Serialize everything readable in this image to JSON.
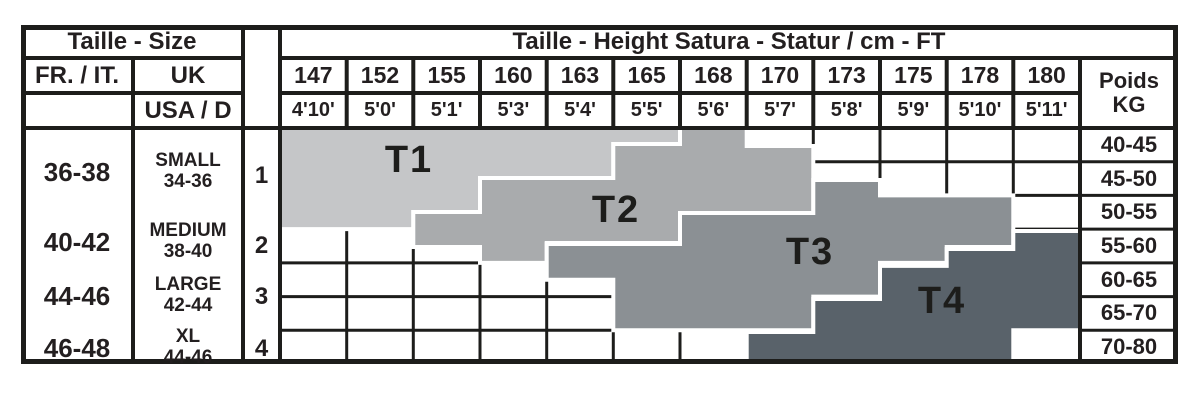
{
  "chart_data": {
    "type": "table",
    "title_left": "Taille - Size",
    "title_right": "Taille - Height Satura - Statur / cm - FT",
    "col_headers": {
      "fr_it": "FR. / IT.",
      "uk": "UK",
      "usa_d": "USA / D"
    },
    "weight_header": {
      "line1": "Poids",
      "line2": "KG"
    },
    "heights_cm": [
      "147",
      "152",
      "155",
      "160",
      "163",
      "165",
      "168",
      "170",
      "173",
      "175",
      "178",
      "180"
    ],
    "heights_ft": [
      "4'10'",
      "5'0'",
      "5'1'",
      "5'3'",
      "5'4'",
      "5'5'",
      "5'6'",
      "5'7'",
      "5'8'",
      "5'9'",
      "5'10'",
      "5'11'"
    ],
    "weights_kg": [
      "40-45",
      "45-50",
      "50-55",
      "55-60",
      "60-65",
      "65-70",
      "70-80"
    ],
    "size_rows": [
      {
        "fr_it": "36-38",
        "uk": "SMALL",
        "uk_range": "34-36",
        "usa_d": "1"
      },
      {
        "fr_it": "40-42",
        "uk": "MEDIUM",
        "uk_range": "38-40",
        "usa_d": "2"
      },
      {
        "fr_it": "44-46",
        "uk": "LARGE",
        "uk_range": "42-44",
        "usa_d": "3"
      },
      {
        "fr_it": "46-48",
        "uk": "XL",
        "uk_range": "44-46",
        "usa_d": "4"
      }
    ],
    "bands": [
      {
        "label": "T1",
        "color": "#c5c6c8",
        "label_xy": [
          409,
          160
        ],
        "points": [
          [
            280,
            128
          ],
          [
            680,
            128
          ],
          [
            680,
            144
          ],
          [
            613.3,
            144
          ],
          [
            613.3,
            178
          ],
          [
            480,
            178
          ],
          [
            480,
            212
          ],
          [
            413.3,
            212
          ],
          [
            413.3,
            229.1
          ],
          [
            280,
            229.1
          ]
        ]
      },
      {
        "label": "T2",
        "color": "#a9abad",
        "label_xy": [
          616,
          210
        ],
        "points": [
          [
            413.3,
            212
          ],
          [
            480,
            212
          ],
          [
            480,
            178
          ],
          [
            613.3,
            178
          ],
          [
            613.3,
            144
          ],
          [
            680,
            144
          ],
          [
            680,
            128
          ],
          [
            746.7,
            128
          ],
          [
            746.7,
            146
          ],
          [
            813.3,
            146
          ],
          [
            813.3,
            213
          ],
          [
            680,
            213
          ],
          [
            680,
            243
          ],
          [
            546.7,
            243
          ],
          [
            546.7,
            262.9
          ],
          [
            480,
            262.9
          ],
          [
            480,
            247
          ],
          [
            413.3,
            247
          ]
        ]
      },
      {
        "label": "T3",
        "color": "#8b9094",
        "label_xy": [
          810,
          252
        ],
        "points": [
          [
            546.7,
            244
          ],
          [
            680,
            244
          ],
          [
            680,
            213
          ],
          [
            813.3,
            213
          ],
          [
            813.3,
            180
          ],
          [
            880,
            180
          ],
          [
            880,
            195.4
          ],
          [
            1013.3,
            195.4
          ],
          [
            1013.3,
            247
          ],
          [
            946.7,
            247
          ],
          [
            946.7,
            262.9
          ],
          [
            880,
            262.9
          ],
          [
            880,
            296.6
          ],
          [
            813.3,
            296.6
          ],
          [
            813.3,
            330.3
          ],
          [
            613.3,
            330.3
          ],
          [
            613.3,
            279.7
          ],
          [
            546.7,
            279.7
          ]
        ]
      },
      {
        "label": "T4",
        "color": "#59626a",
        "label_xy": [
          942,
          301
        ],
        "points": [
          [
            813.3,
            299
          ],
          [
            880,
            299
          ],
          [
            880,
            265.9
          ],
          [
            946.7,
            265.9
          ],
          [
            946.7,
            249
          ],
          [
            1013.3,
            249
          ],
          [
            1013.3,
            231
          ],
          [
            1080,
            231
          ],
          [
            1080,
            330.3
          ],
          [
            1013.3,
            330.3
          ],
          [
            1013.3,
            364
          ],
          [
            746.7,
            364
          ],
          [
            746.7,
            332
          ],
          [
            813.3,
            332
          ]
        ]
      }
    ]
  },
  "colors": {
    "line": "#1d1d1b",
    "text": "#231f20",
    "background": "#ffffff",
    "band_outline": "#ffffff"
  }
}
